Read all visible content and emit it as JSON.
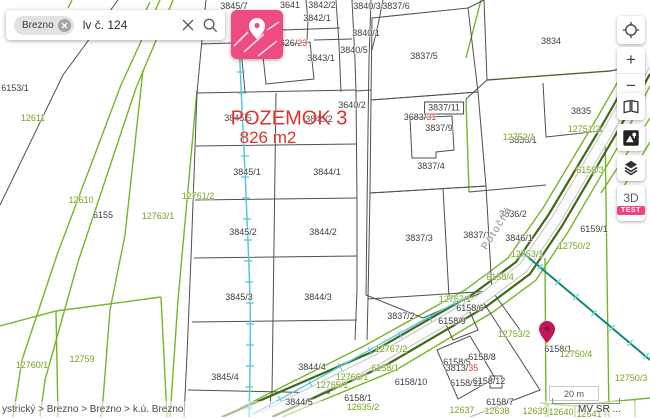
{
  "colors": {
    "accent_pink": "#ee4b85",
    "parcel_line_green": "#76b529",
    "road_line_olive": "#3e6b16",
    "pipeline_cyan": "#56c8d8",
    "pipeline_teal": "#12897c",
    "highlight_red": "#e0312e",
    "pin_magenta": "#c2185b",
    "label_green": "#74a51c"
  },
  "search": {
    "chip": "Brezno",
    "query": "lv č. 124"
  },
  "controls": {
    "zoom_in": "+",
    "zoom_out": "−",
    "mode_3d": "3D",
    "badge": "TEST",
    "icons": [
      "locate-icon",
      "zoom-in-icon",
      "zoom-out-icon",
      "compare-icon",
      "basemap-icon",
      "layers-icon"
    ]
  },
  "highlight": {
    "name": "POZEMOK 3",
    "area": "826 m2"
  },
  "footer": {
    "breadcrumb": "ystrický > Brezno > Brezno > k.ú. Brezno",
    "attribution": "MV SR ...",
    "scale": "20 m"
  },
  "map": {
    "labels": [
      {
        "t": "3845/7",
        "x": 234,
        "y": 6
      },
      {
        "t": "3641",
        "x": 290,
        "y": 5
      },
      {
        "t": "3842/2",
        "x": 322,
        "y": 5
      },
      {
        "t": "3842/1",
        "x": 317,
        "y": 18
      },
      {
        "t": "3840/3",
        "x": 367,
        "y": 6
      },
      {
        "t": "3837/6",
        "x": 396,
        "y": 6
      },
      {
        "t": "3840/1",
        "x": 366,
        "y": 33
      },
      {
        "t": "3840/5",
        "x": 354,
        "y": 50
      },
      {
        "t": "3845/6",
        "x": 253,
        "y": 53
      },
      {
        "t": "3843/1",
        "x": 321,
        "y": 58
      },
      {
        "t": "3837/5",
        "x": 424,
        "y": 56
      },
      {
        "t": "1626/",
        "red": "23",
        "x": 291,
        "y": 43
      },
      {
        "t": "3640/2",
        "x": 352,
        "y": 105
      },
      {
        "t": "3837/11",
        "x": 444,
        "y": 108,
        "c": "box"
      },
      {
        "t": "3683/",
        "red": "31",
        "x": 420,
        "y": 117
      },
      {
        "t": "3837/9",
        "x": 439,
        "y": 128
      },
      {
        "t": "3837/4",
        "x": 431,
        "y": 166
      },
      {
        "t": "3845/5",
        "x": 238,
        "y": 118
      },
      {
        "t": "3843/2",
        "x": 319,
        "y": 119
      },
      {
        "t": "3845/1",
        "x": 247,
        "y": 172
      },
      {
        "t": "3844/1",
        "x": 327,
        "y": 172
      },
      {
        "t": "3845/2",
        "x": 243,
        "y": 232
      },
      {
        "t": "3844/2",
        "x": 323,
        "y": 232
      },
      {
        "t": "3845/3",
        "x": 239,
        "y": 297
      },
      {
        "t": "3844/3",
        "x": 318,
        "y": 297
      },
      {
        "t": "3845/4",
        "x": 225,
        "y": 377
      },
      {
        "t": "3844/4",
        "x": 312,
        "y": 367
      },
      {
        "t": "3844/5",
        "x": 299,
        "y": 402
      },
      {
        "t": "3837/3",
        "x": 419,
        "y": 238
      },
      {
        "t": "3837/1",
        "x": 477,
        "y": 235
      },
      {
        "t": "3837/2",
        "x": 401,
        "y": 316
      },
      {
        "t": "3836/1",
        "x": 523,
        "y": 140
      },
      {
        "t": "3836/2",
        "x": 513,
        "y": 214
      },
      {
        "t": "3835",
        "x": 581,
        "y": 111
      },
      {
        "t": "3834",
        "x": 551,
        "y": 41
      },
      {
        "t": "3846/1",
        "x": 519,
        "y": 238
      },
      {
        "t": "6159/1",
        "x": 594,
        "y": 229
      },
      {
        "t": "6158/1",
        "x": 558,
        "y": 349
      },
      {
        "t": "6158/1",
        "x": 358,
        "y": 398
      },
      {
        "t": "6158/10",
        "x": 411,
        "y": 382
      },
      {
        "t": "6158/6",
        "x": 470,
        "y": 308
      },
      {
        "t": "6158/9",
        "x": 452,
        "y": 321
      },
      {
        "t": "6158/8",
        "x": 482,
        "y": 357
      },
      {
        "t": "6158/5",
        "x": 457,
        "y": 362
      },
      {
        "t": "3813/",
        "red": "35",
        "x": 462,
        "y": 368
      },
      {
        "t": "6158/11",
        "x": 466,
        "y": 383
      },
      {
        "t": "6158/12",
        "x": 489,
        "y": 381
      },
      {
        "t": "6158/7",
        "x": 500,
        "y": 402
      },
      {
        "t": "6155",
        "x": 103,
        "y": 215
      },
      {
        "t": "6153/1",
        "x": 15,
        "y": 88
      },
      {
        "t": "12611",
        "x": 33,
        "y": 118,
        "c": "g"
      },
      {
        "t": "12610",
        "x": 81,
        "y": 200,
        "c": "g"
      },
      {
        "t": "12763/1",
        "x": 158,
        "y": 216,
        "c": "g"
      },
      {
        "t": "12761/2",
        "x": 198,
        "y": 196,
        "c": "g"
      },
      {
        "t": "12760/1",
        "x": 32,
        "y": 365,
        "c": "g"
      },
      {
        "t": "12759",
        "x": 82,
        "y": 359,
        "c": "g"
      },
      {
        "t": "12767/1",
        "x": 455,
        "y": 299,
        "c": "g"
      },
      {
        "t": "12767/2",
        "x": 391,
        "y": 349,
        "c": "g"
      },
      {
        "t": "12766/1",
        "x": 352,
        "y": 377,
        "c": "g"
      },
      {
        "t": "12765/1",
        "x": 332,
        "y": 385,
        "c": "g"
      },
      {
        "t": "6158/1",
        "x": 385,
        "y": 368,
        "c": "g"
      },
      {
        "t": "12635/2",
        "x": 363,
        "y": 407,
        "c": "g"
      },
      {
        "t": "12637",
        "x": 462,
        "y": 410,
        "c": "g"
      },
      {
        "t": "12638",
        "x": 497,
        "y": 411,
        "c": "g"
      },
      {
        "t": "12639",
        "x": 535,
        "y": 411,
        "c": "g"
      },
      {
        "t": "12640",
        "x": 561,
        "y": 412,
        "c": "g"
      },
      {
        "t": "12641",
        "x": 589,
        "y": 414,
        "c": "g"
      },
      {
        "t": "6158/3",
        "x": 590,
        "y": 170,
        "c": "g"
      },
      {
        "t": "6158/4",
        "x": 500,
        "y": 277,
        "c": "g"
      },
      {
        "t": "12753/2",
        "x": 514,
        "y": 334,
        "c": "g"
      },
      {
        "t": "12753/1",
        "x": 527,
        "y": 254,
        "c": "g"
      },
      {
        "t": "12750/2",
        "x": 574,
        "y": 246,
        "c": "g"
      },
      {
        "t": "12750/4",
        "x": 576,
        "y": 354,
        "c": "g"
      },
      {
        "t": "12750/3",
        "x": 631,
        "y": 378,
        "c": "g"
      },
      {
        "t": "12751/2",
        "x": 584,
        "y": 129,
        "c": "g"
      },
      {
        "t": "12752/1",
        "x": 519,
        "y": 137,
        "c": "g"
      },
      {
        "t": "Potočná",
        "x": 497,
        "y": 228,
        "c": "s",
        "rot": -58
      }
    ]
  }
}
